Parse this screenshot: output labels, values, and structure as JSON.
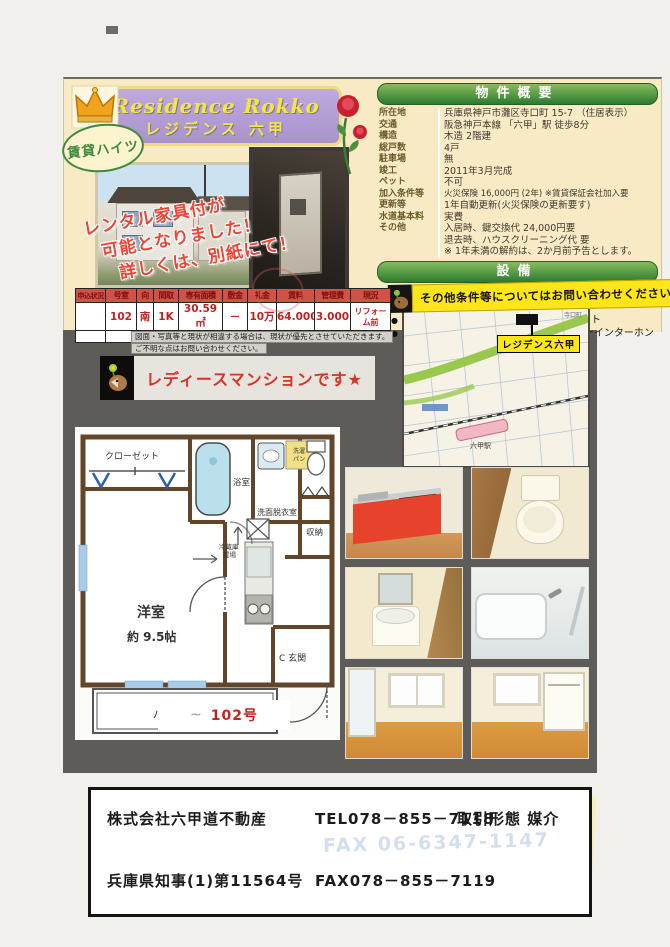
{
  "header": {
    "title_en": "Residence Rokko",
    "title_jp": "レジデンス 六甲",
    "badge": "賃貸ハイツ",
    "rental_notice": [
      "レンタル家具付が",
      "可能となりました！",
      "詳しくは、別紙にて！"
    ]
  },
  "summary": {
    "title": "物件概要",
    "rows": [
      {
        "label": "所在地",
        "value": "兵庫県神戸市灘区寺口町 15-7 （住居表示）"
      },
      {
        "label": "交通",
        "value": "阪急神戸本線 「六甲」駅 徒歩8分"
      },
      {
        "label": "構造",
        "value": "木造 2階建"
      },
      {
        "label": "総戸数",
        "value": "4戸"
      },
      {
        "label": "駐車場",
        "value": "無"
      },
      {
        "label": "竣工",
        "value": "2011年3月完成"
      },
      {
        "label": "ペット",
        "value": "不可"
      },
      {
        "label": "加入条件等",
        "value": "火災保険 16,000円 (2年) ※賃貸保証会社加入要"
      },
      {
        "label": "更新等",
        "value": "1年自動更新(火災保険の更新要す)"
      },
      {
        "label": "水道基本料",
        "value": "実費"
      },
      {
        "label": "その他",
        "value": "入居時、鍵交換代 24,000円要"
      },
      {
        "label": "",
        "value": "退去時、ハウスクリーニング代 要"
      },
      {
        "label": "",
        "value": "※ 1年未満の解約は、2か月前予告とします。"
      }
    ]
  },
  "equipment": {
    "title": "設備",
    "left": [
      "オートロック",
      "駐輪場",
      "インターネット対応",
      "レディースマンション"
    ],
    "right": [
      "IHコンロ",
      "室内洗濯パン",
      "クローゼット",
      "TVモニターインターホン",
      "エアコン",
      "独立洗面台"
    ]
  },
  "inquiry_banner": {
    "text": "その他条件等についてはお問い合わせください"
  },
  "map": {
    "property_label": "レジデンス六甲",
    "town_label": "寺口町",
    "station_label": "六甲駅"
  },
  "rent_table": {
    "headers": [
      "申込状況",
      "号室",
      "向",
      "間取",
      "専有面積",
      "敷金",
      "礼金",
      "賃料",
      "管理費",
      "現況"
    ],
    "row": [
      "",
      "102",
      "南",
      "1K",
      "30.59㎡",
      "－",
      "10万",
      "64.000",
      "3.000",
      "リフォーム前"
    ],
    "notes": [
      "図面・写真等と現状が相違する場合は、現状が優先とさせていただきます。",
      "ご不明な点はお問い合わせください。"
    ]
  },
  "ladies_banner": {
    "text": "レディースマンションです★"
  },
  "floorplan": {
    "closet": "クローゼット",
    "bathroom": "浴室",
    "washroom": "洗面脱衣室",
    "laundry_1": "洗濯",
    "laundry_2": "パン",
    "storage": "収納",
    "fridge_1": "冷蔵庫",
    "fridge_2": "置場",
    "room": "洋室",
    "room_size": "約 9.5帖",
    "entrance": "C 玄関",
    "balcony": "バルコニー",
    "unit_label": "102号"
  },
  "footer": {
    "company": "株式会社六甲道不動産",
    "tel": "TEL078－855－7118",
    "deal_label": "取引形態 媒介",
    "license": "兵庫県知事(1)第11564号",
    "fax": "FAX078－855－7119",
    "ghost_fax": "FAX 06-6347-1147"
  },
  "colors": {
    "accent_green": "#2d7a2f",
    "banner_purple": "#b0a0d2",
    "highlight_yellow": "#ffe51a",
    "price_red": "#c21f1f"
  }
}
